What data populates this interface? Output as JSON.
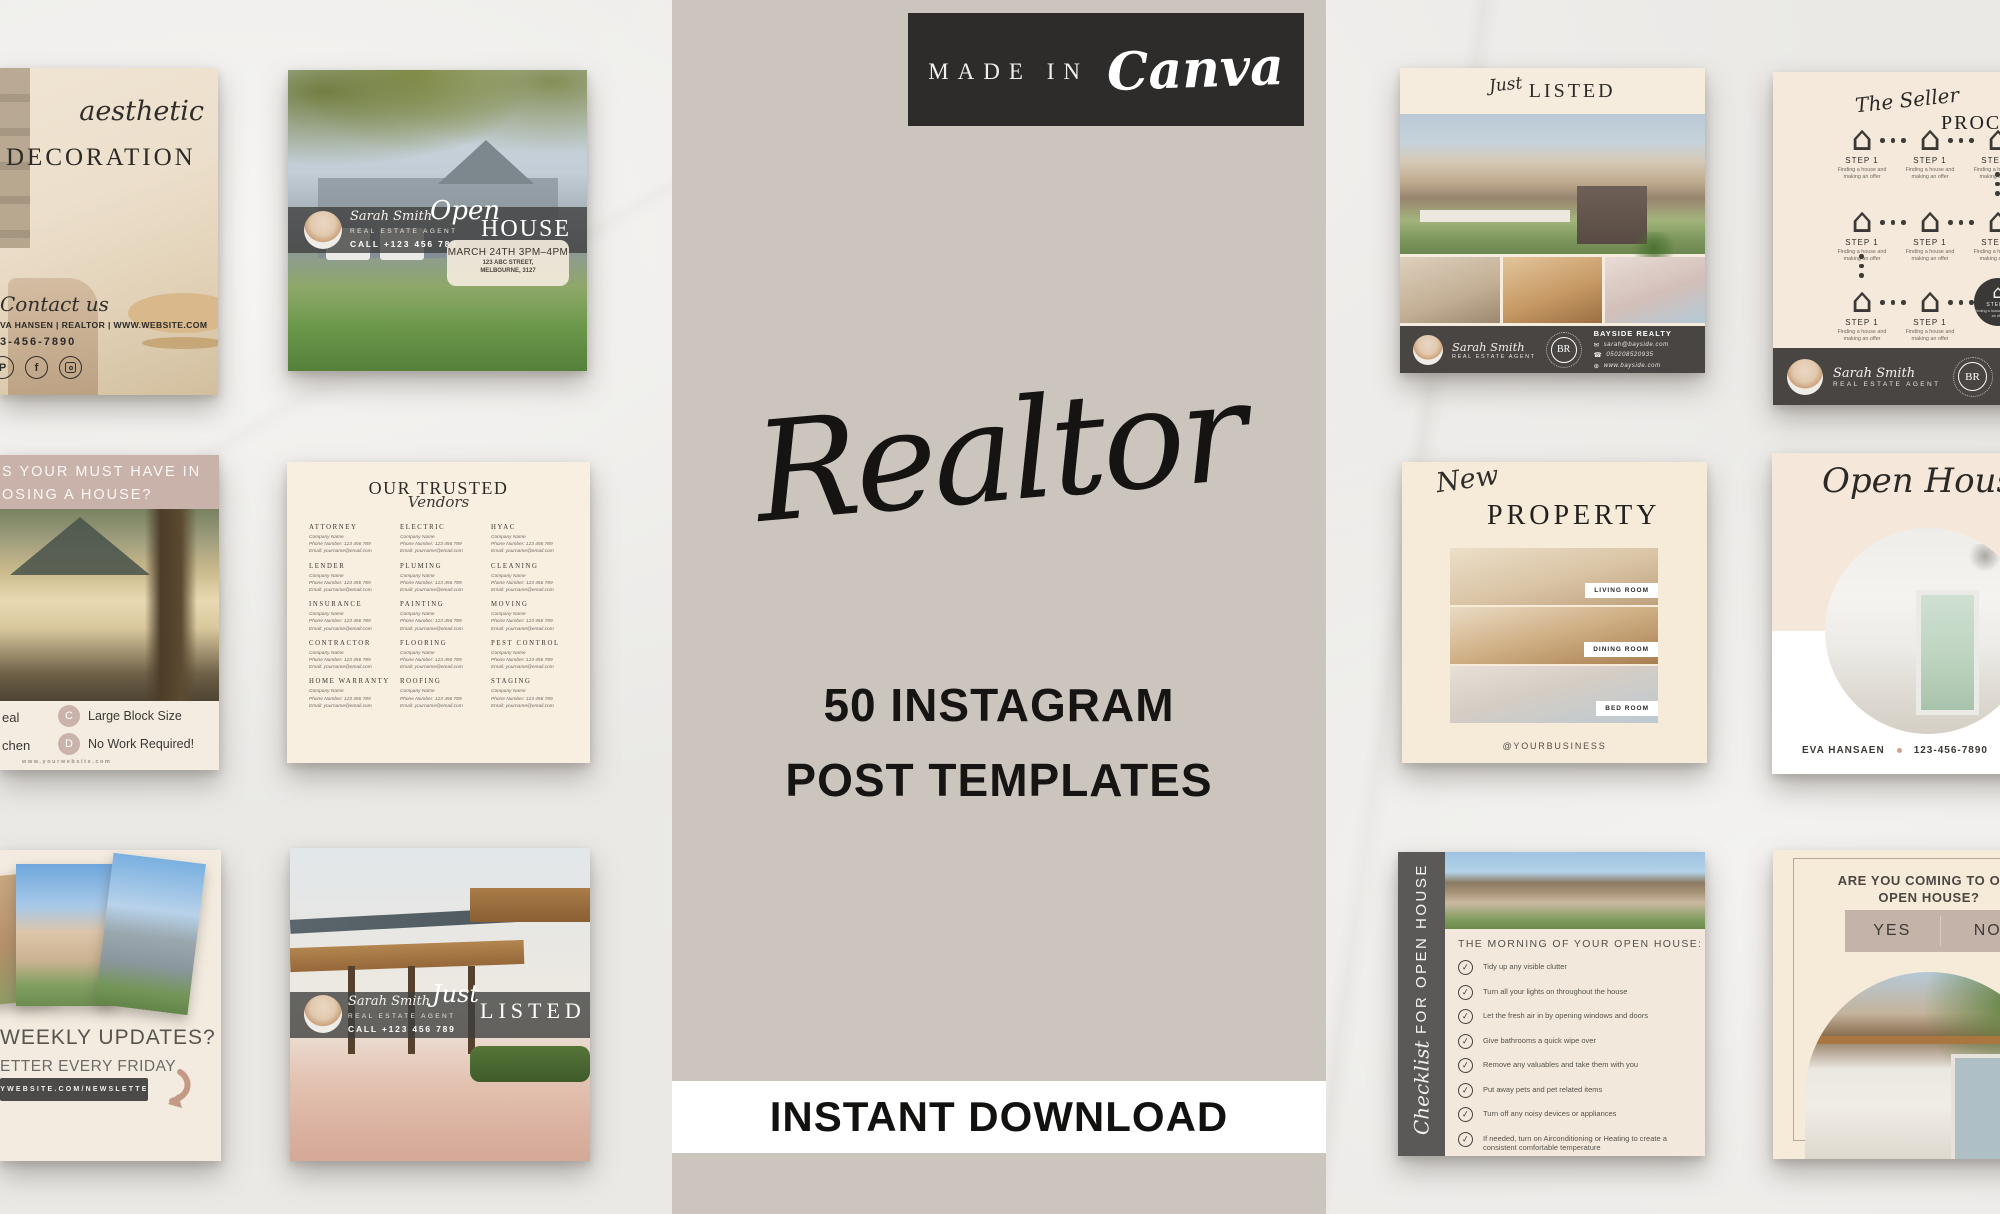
{
  "icons": {
    "house": "⌂",
    "check": "✓",
    "email": "✉",
    "phone": "☎",
    "globe": "⊕",
    "facebook": "f",
    "pinterest": "P"
  },
  "center_panel": {
    "badge": {
      "prefix": "MADE IN",
      "brand": "Canva"
    },
    "title": "Realtor",
    "subtitle_line1": "50 INSTAGRAM",
    "subtitle_line2": "POST TEMPLATES",
    "banner": "INSTANT DOWNLOAD"
  },
  "cards": {
    "decoration": {
      "script": "aesthetic",
      "heading": "DECORATION",
      "contact_script": "Contact us",
      "agent_line": "VA HANSEN | REALTOR | WWW.WEBSITE.COM",
      "phone": "3-456-7890"
    },
    "must_have": {
      "header_line1": "S YOUR MUST HAVE IN",
      "header_line2": "OSING A HOUSE?",
      "option_cut1": "eal",
      "option_cut2": "chen",
      "option_c_letter": "C",
      "option_c_label": "Large Block Size",
      "option_d_letter": "D",
      "option_d_label": "No Work Required!",
      "website": "www.yourwebsite.com"
    },
    "weekly": {
      "heading": "WEEKLY UPDATES?",
      "subheading": "ETTER EVERY FRIDAY",
      "pill": "MYWEBSITE.COM/NEWSLETTER"
    },
    "open_house_photo": {
      "agent_name": "Sarah Smith",
      "agent_role": "REAL ESTATE AGENT",
      "agent_call": "CALL +123 456 789",
      "script": "Open",
      "heading": "HOUSE",
      "date": "MARCH 24TH 3PM–4PM",
      "address_line1": "123 ABC STREET,",
      "address_line2": "MELBOURNE, 3127"
    },
    "vendors": {
      "title": "OUR TRUSTED",
      "title_script": "Vendors",
      "detail_lines": [
        "Company Name",
        "Phone Number: 123 456 789",
        "Email: yourname@email.com"
      ],
      "categories": [
        "ATTORNEY",
        "ELECTRIC",
        "HYAC",
        "LENDER",
        "PLUMING",
        "CLEANING",
        "INSURANCE",
        "PAINTING",
        "MOVING",
        "CONTRACTOR",
        "FLOORING",
        "PEST CONTROL",
        "HOME WARRANTY",
        "ROOFING",
        "STAGING"
      ]
    },
    "just_listed_photo": {
      "agent_name": "Sarah Smith",
      "agent_role": "REAL ESTATE AGENT",
      "agent_call": "CALL +123 456 789",
      "script": "Just",
      "heading": "LISTED"
    },
    "just_listed_collage": {
      "script": "Just",
      "heading": "LISTED",
      "agent_name": "Sarah Smith",
      "agent_role": "REAL ESTATE AGENT",
      "logo_initials": "BR",
      "company": "BAYSIDE REALTY",
      "email": "sarah@bayside.com",
      "phone": "050208520935",
      "website": "www.bayside.com"
    },
    "new_property": {
      "script": "New",
      "heading": "PROPERTY",
      "label_living": "LIVING ROOM",
      "label_dining": "DINING ROOM",
      "label_bed": "BED ROOM",
      "handle": "@YOURBUSINESS"
    },
    "seller_process": {
      "script": "The Seller",
      "heading": "PROCESS",
      "step_label": "STEP 1",
      "step_desc": "Finding a house and making an offer",
      "agent_name": "Sarah Smith",
      "agent_role": "REAL ESTATE AGENT",
      "logo_initials": "BR",
      "company": "BAYSIDE REALTY",
      "email": "sarah@bayside.com",
      "phone": "050208520935",
      "website": "www.bayside.com"
    },
    "open_house_circle": {
      "script": "Open House",
      "agent": "EVA HANSAEN",
      "phone": "123-456-7890",
      "handle": "@YOURBUSINESS"
    },
    "checklist": {
      "sidebar_script": "Checklist",
      "sidebar_caps": "FOR OPEN HOUSE",
      "heading": "THE MORNING OF YOUR OPEN HOUSE:",
      "items": [
        "Tidy up any visible clutter",
        "Turn all your lights on throughout the house",
        "Let the fresh air in by opening windows and doors",
        "Give bathrooms a quick wipe over",
        "Remove any valuables and take them with you",
        "Put away pets and pet related items",
        "Turn off any noisy devices or appliances",
        "If needed, turn on Airconditioning or Heating to create a consistent comfortable temperature"
      ]
    },
    "rsvp": {
      "heading_line1": "ARE YOU COMING TO OUR",
      "heading_line2": "OPEN HOUSE?",
      "yes": "YES",
      "no": "NO"
    }
  }
}
